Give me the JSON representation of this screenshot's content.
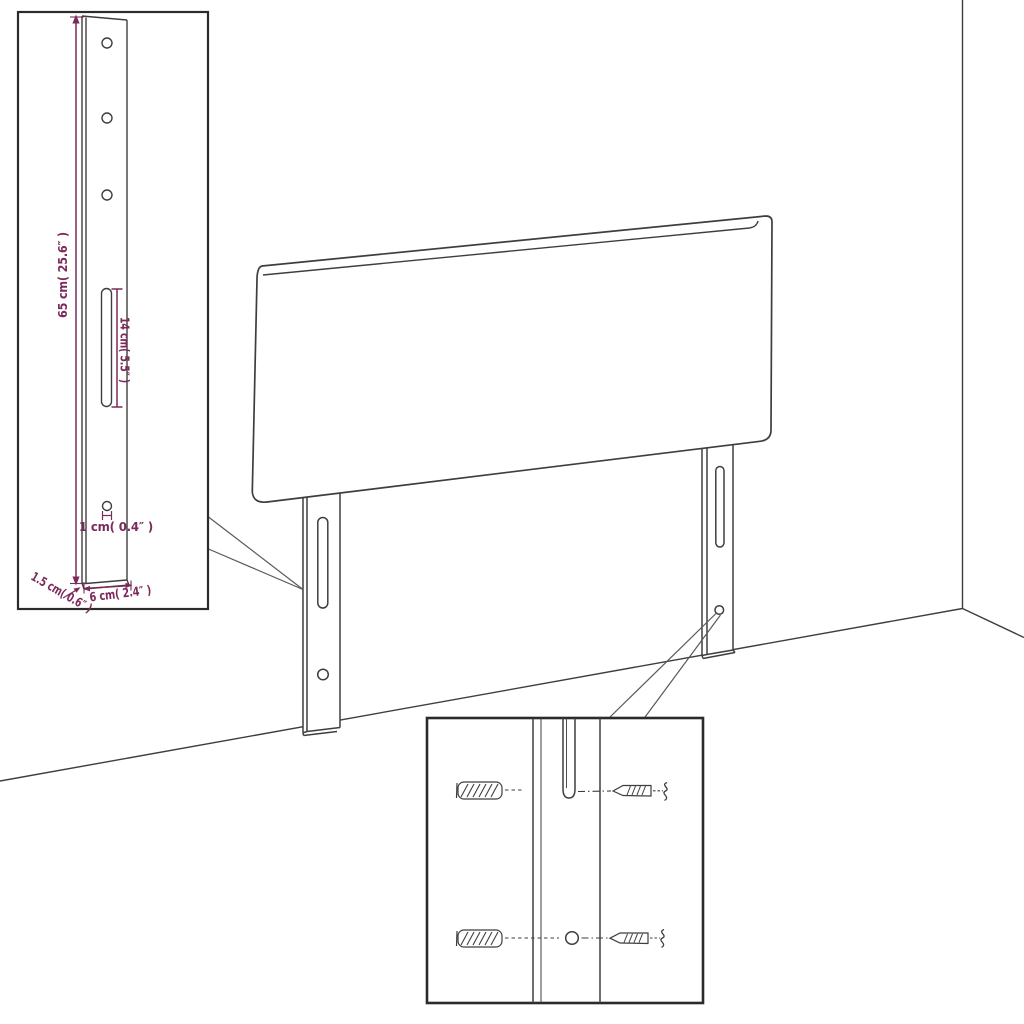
{
  "colors": {
    "background": "#ffffff",
    "line_art": "#3e3e3e",
    "inset_border": "#2b2b2b",
    "callout": "#5a5a5a",
    "dimension": "#7b2a5c"
  },
  "leg_detail_inset": {
    "height_label": "65 cm( 25.6″ )",
    "slot_length_label": "14 cm( 5.5″ )",
    "hole_diameter_label": "1 cm( 0.4″ )",
    "thickness_label": "1.5 cm( 0.6″ )",
    "width_label": "6 cm( 2.4″ )"
  }
}
